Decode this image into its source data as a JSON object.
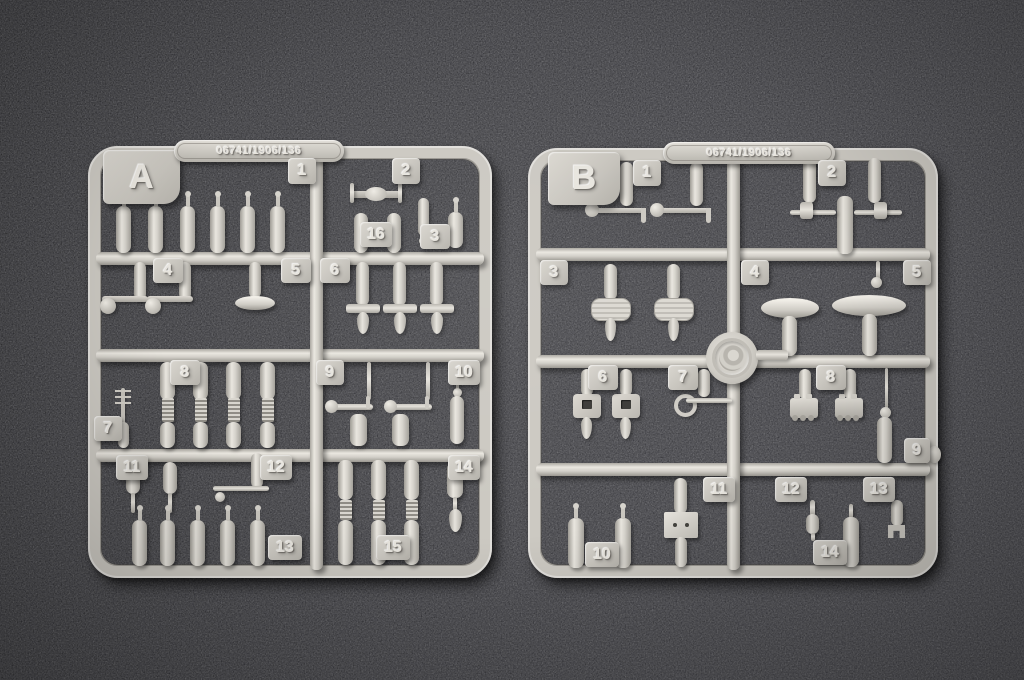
{
  "colors": {
    "mat_dark": "#2c2c2e",
    "mat_mid": "#37373a",
    "mat_light": "#434347",
    "plastic": "#cfccc5",
    "plastic_light": "#ece9e2",
    "plastic_shadow": "#a19e97",
    "emboss_text": "#e8e5de"
  },
  "sprues": {
    "a": {
      "letter": "A",
      "mold_code": "06741/1906/136",
      "tags": [
        {
          "label": "1",
          "x": 200,
          "y": 12,
          "w": 28,
          "h": 26
        },
        {
          "label": "2",
          "x": 304,
          "y": 12,
          "w": 28,
          "h": 26
        },
        {
          "label": "16",
          "x": 272,
          "y": 76,
          "w": 32,
          "h": 25
        },
        {
          "label": "3",
          "x": 332,
          "y": 78,
          "w": 30,
          "h": 25
        },
        {
          "label": "4",
          "x": 65,
          "y": 112,
          "w": 30,
          "h": 25
        },
        {
          "label": "5",
          "x": 193,
          "y": 112,
          "w": 30,
          "h": 25
        },
        {
          "label": "6",
          "x": 232,
          "y": 112,
          "w": 30,
          "h": 25
        },
        {
          "label": "7",
          "x": 6,
          "y": 270,
          "w": 28,
          "h": 25
        },
        {
          "label": "8",
          "x": 82,
          "y": 214,
          "w": 30,
          "h": 25
        },
        {
          "label": "9",
          "x": 228,
          "y": 214,
          "w": 28,
          "h": 25
        },
        {
          "label": "10",
          "x": 360,
          "y": 214,
          "w": 32,
          "h": 25
        },
        {
          "label": "11",
          "x": 28,
          "y": 309,
          "w": 32,
          "h": 25
        },
        {
          "label": "12",
          "x": 172,
          "y": 309,
          "w": 32,
          "h": 25
        },
        {
          "label": "14",
          "x": 360,
          "y": 309,
          "w": 32,
          "h": 25
        },
        {
          "label": "13",
          "x": 180,
          "y": 389,
          "w": 34,
          "h": 25
        },
        {
          "label": "15",
          "x": 288,
          "y": 389,
          "w": 34,
          "h": 25
        }
      ],
      "parts": [
        {
          "t": "bottle",
          "x": 28,
          "y": 60,
          "w": 15,
          "h": 47
        },
        {
          "t": "bottle",
          "x": 60,
          "y": 60,
          "w": 15,
          "h": 47
        },
        {
          "t": "bottle",
          "x": 92,
          "y": 60,
          "w": 15,
          "h": 47
        },
        {
          "t": "bottle",
          "x": 122,
          "y": 60,
          "w": 15,
          "h": 47
        },
        {
          "t": "bottle",
          "x": 152,
          "y": 60,
          "w": 15,
          "h": 47
        },
        {
          "t": "bottle",
          "x": 182,
          "y": 60,
          "w": 15,
          "h": 47
        },
        {
          "t": "axle",
          "x": 262,
          "y": 45,
          "w": 52,
          "h": 7
        },
        {
          "t": "bar",
          "x": 262,
          "y": 37,
          "w": 4,
          "h": 20
        },
        {
          "t": "bar",
          "x": 310,
          "y": 37,
          "w": 4,
          "h": 20
        },
        {
          "t": "capsule",
          "x": 266,
          "y": 67,
          "w": 14,
          "h": 40
        },
        {
          "t": "capsule",
          "x": 299,
          "y": 67,
          "w": 14,
          "h": 40
        },
        {
          "t": "capsule",
          "x": 330,
          "y": 52,
          "w": 11,
          "h": 38
        },
        {
          "t": "ball",
          "x": 331,
          "y": 91,
          "w": 8,
          "h": 8
        },
        {
          "t": "bottle",
          "x": 360,
          "y": 66,
          "w": 15,
          "h": 36
        },
        {
          "t": "capsule",
          "x": 46,
          "y": 116,
          "w": 12,
          "h": 38
        },
        {
          "t": "capsule",
          "x": 91,
          "y": 116,
          "w": 12,
          "h": 38
        },
        {
          "t": "davit",
          "x": 14,
          "y": 150,
          "w": 46,
          "h": 22
        },
        {
          "t": "davit",
          "x": 59,
          "y": 150,
          "w": 46,
          "h": 22
        },
        {
          "t": "capsule",
          "x": 161,
          "y": 116,
          "w": 12,
          "h": 36
        },
        {
          "t": "ellipse",
          "x": 147,
          "y": 150,
          "w": 40,
          "h": 14
        },
        {
          "t": "capsule",
          "x": 268,
          "y": 116,
          "w": 13,
          "h": 44
        },
        {
          "t": "bar",
          "x": 258,
          "y": 158,
          "w": 34,
          "h": 9
        },
        {
          "t": "tear",
          "x": 269,
          "y": 166,
          "w": 12,
          "h": 22
        },
        {
          "t": "capsule",
          "x": 305,
          "y": 116,
          "w": 13,
          "h": 44
        },
        {
          "t": "bar",
          "x": 295,
          "y": 158,
          "w": 34,
          "h": 9
        },
        {
          "t": "tear",
          "x": 306,
          "y": 166,
          "w": 12,
          "h": 22
        },
        {
          "t": "capsule",
          "x": 342,
          "y": 116,
          "w": 13,
          "h": 44
        },
        {
          "t": "bar",
          "x": 332,
          "y": 158,
          "w": 34,
          "h": 9
        },
        {
          "t": "tear",
          "x": 343,
          "y": 166,
          "w": 12,
          "h": 22
        },
        {
          "t": "mast",
          "x": 27,
          "y": 242,
          "w": 16,
          "h": 36
        },
        {
          "t": "capsule",
          "x": 30,
          "y": 276,
          "w": 11,
          "h": 26
        },
        {
          "t": "capsule",
          "x": 72,
          "y": 216,
          "w": 15,
          "h": 38
        },
        {
          "t": "ribbed",
          "x": 74,
          "y": 252,
          "w": 12,
          "h": 24
        },
        {
          "t": "capsule",
          "x": 72,
          "y": 276,
          "w": 15,
          "h": 26
        },
        {
          "t": "capsule",
          "x": 105,
          "y": 216,
          "w": 15,
          "h": 38
        },
        {
          "t": "ribbed",
          "x": 107,
          "y": 252,
          "w": 12,
          "h": 24
        },
        {
          "t": "capsule",
          "x": 105,
          "y": 276,
          "w": 15,
          "h": 26
        },
        {
          "t": "capsule",
          "x": 138,
          "y": 216,
          "w": 15,
          "h": 38
        },
        {
          "t": "ribbed",
          "x": 140,
          "y": 252,
          "w": 12,
          "h": 24
        },
        {
          "t": "capsule",
          "x": 138,
          "y": 276,
          "w": 15,
          "h": 26
        },
        {
          "t": "capsule",
          "x": 172,
          "y": 216,
          "w": 15,
          "h": 38
        },
        {
          "t": "ribbed",
          "x": 174,
          "y": 252,
          "w": 12,
          "h": 24
        },
        {
          "t": "capsule",
          "x": 172,
          "y": 276,
          "w": 15,
          "h": 26
        },
        {
          "t": "bar",
          "x": 279,
          "y": 216,
          "w": 4,
          "h": 38
        },
        {
          "t": "bar",
          "x": 338,
          "y": 216,
          "w": 4,
          "h": 38
        },
        {
          "t": "gun",
          "x": 243,
          "y": 258,
          "w": 42,
          "h": 6
        },
        {
          "t": "gun",
          "x": 302,
          "y": 258,
          "w": 42,
          "h": 6
        },
        {
          "t": "capsule",
          "x": 262,
          "y": 268,
          "w": 17,
          "h": 32
        },
        {
          "t": "capsule",
          "x": 304,
          "y": 268,
          "w": 17,
          "h": 32
        },
        {
          "t": "bar",
          "x": 368,
          "y": 216,
          "w": 3,
          "h": 28
        },
        {
          "t": "ball",
          "x": 365,
          "y": 242,
          "w": 9,
          "h": 9
        },
        {
          "t": "capsule",
          "x": 362,
          "y": 250,
          "w": 14,
          "h": 48
        },
        {
          "t": "capsule",
          "x": 38,
          "y": 316,
          "w": 14,
          "h": 32
        },
        {
          "t": "bar",
          "x": 43,
          "y": 347,
          "w": 4,
          "h": 20
        },
        {
          "t": "capsule",
          "x": 75,
          "y": 316,
          "w": 14,
          "h": 32
        },
        {
          "t": "bar",
          "x": 80,
          "y": 347,
          "w": 4,
          "h": 20
        },
        {
          "t": "capsule",
          "x": 163,
          "y": 307,
          "w": 12,
          "h": 35
        },
        {
          "t": "bar",
          "x": 125,
          "y": 340,
          "w": 56,
          "h": 5
        },
        {
          "t": "ball",
          "x": 127,
          "y": 346,
          "w": 10,
          "h": 10
        },
        {
          "t": "bottle",
          "x": 44,
          "y": 374,
          "w": 15,
          "h": 46
        },
        {
          "t": "bottle",
          "x": 72,
          "y": 374,
          "w": 15,
          "h": 46
        },
        {
          "t": "bottle",
          "x": 102,
          "y": 374,
          "w": 15,
          "h": 46
        },
        {
          "t": "bottle",
          "x": 132,
          "y": 374,
          "w": 15,
          "h": 46
        },
        {
          "t": "bottle",
          "x": 162,
          "y": 374,
          "w": 15,
          "h": 46
        },
        {
          "t": "capsule",
          "x": 359,
          "y": 316,
          "w": 16,
          "h": 36
        },
        {
          "t": "bar",
          "x": 365,
          "y": 351,
          "w": 4,
          "h": 14
        },
        {
          "t": "tear",
          "x": 361,
          "y": 363,
          "w": 13,
          "h": 23
        },
        {
          "t": "capsule",
          "x": 250,
          "y": 314,
          "w": 15,
          "h": 40
        },
        {
          "t": "ribbed",
          "x": 252,
          "y": 354,
          "w": 12,
          "h": 20
        },
        {
          "t": "capsule",
          "x": 250,
          "y": 374,
          "w": 15,
          "h": 45
        },
        {
          "t": "capsule",
          "x": 283,
          "y": 314,
          "w": 15,
          "h": 40
        },
        {
          "t": "ribbed",
          "x": 285,
          "y": 354,
          "w": 12,
          "h": 20
        },
        {
          "t": "capsule",
          "x": 283,
          "y": 374,
          "w": 15,
          "h": 45
        },
        {
          "t": "capsule",
          "x": 316,
          "y": 314,
          "w": 15,
          "h": 40
        },
        {
          "t": "ribbed",
          "x": 318,
          "y": 354,
          "w": 12,
          "h": 20
        },
        {
          "t": "capsule",
          "x": 316,
          "y": 374,
          "w": 15,
          "h": 45
        }
      ]
    },
    "b": {
      "letter": "B",
      "mold_code": "06741/1906/136",
      "tags": [
        {
          "label": "1",
          "x": 105,
          "y": 12,
          "w": 28,
          "h": 26
        },
        {
          "label": "2",
          "x": 290,
          "y": 12,
          "w": 28,
          "h": 26
        },
        {
          "label": "3",
          "x": 12,
          "y": 112,
          "w": 28,
          "h": 25
        },
        {
          "label": "4",
          "x": 213,
          "y": 112,
          "w": 28,
          "h": 25
        },
        {
          "label": "5",
          "x": 375,
          "y": 112,
          "w": 28,
          "h": 25
        },
        {
          "label": "6",
          "x": 60,
          "y": 217,
          "w": 30,
          "h": 25
        },
        {
          "label": "7",
          "x": 140,
          "y": 217,
          "w": 30,
          "h": 25
        },
        {
          "label": "8",
          "x": 288,
          "y": 217,
          "w": 30,
          "h": 25
        },
        {
          "label": "9",
          "x": 376,
          "y": 290,
          "w": 26,
          "h": 25
        },
        {
          "label": "11",
          "x": 175,
          "y": 329,
          "w": 32,
          "h": 25
        },
        {
          "label": "12",
          "x": 247,
          "y": 329,
          "w": 32,
          "h": 25
        },
        {
          "label": "13",
          "x": 335,
          "y": 329,
          "w": 32,
          "h": 25
        },
        {
          "label": "10",
          "x": 57,
          "y": 394,
          "w": 34,
          "h": 25
        },
        {
          "label": "14",
          "x": 285,
          "y": 392,
          "w": 34,
          "h": 25
        }
      ],
      "parts": [
        {
          "t": "capsule",
          "x": 92,
          "y": 14,
          "w": 13,
          "h": 44
        },
        {
          "t": "capsule",
          "x": 162,
          "y": 14,
          "w": 13,
          "h": 44
        },
        {
          "t": "pipe",
          "x": 64,
          "y": 60,
          "w": 52,
          "h": 5
        },
        {
          "t": "pipe",
          "x": 129,
          "y": 60,
          "w": 52,
          "h": 5
        },
        {
          "t": "capsule",
          "x": 275,
          "y": 10,
          "w": 13,
          "h": 45
        },
        {
          "t": "capsule",
          "x": 340,
          "y": 10,
          "w": 13,
          "h": 45
        },
        {
          "t": "capsule",
          "x": 309,
          "y": 48,
          "w": 16,
          "h": 58
        },
        {
          "t": "bar",
          "x": 262,
          "y": 62,
          "w": 46,
          "h": 5
        },
        {
          "t": "bar",
          "x": 326,
          "y": 62,
          "w": 48,
          "h": 5
        },
        {
          "t": "bar",
          "x": 272,
          "y": 54,
          "w": 13,
          "h": 17
        },
        {
          "t": "bar",
          "x": 346,
          "y": 54,
          "w": 13,
          "h": 17
        },
        {
          "t": "capsule",
          "x": 76,
          "y": 116,
          "w": 13,
          "h": 36
        },
        {
          "t": "ovalplate",
          "x": 63,
          "y": 150,
          "w": 38,
          "h": 21
        },
        {
          "t": "tear",
          "x": 77,
          "y": 170,
          "w": 11,
          "h": 23
        },
        {
          "t": "capsule",
          "x": 139,
          "y": 116,
          "w": 13,
          "h": 36
        },
        {
          "t": "ovalplate",
          "x": 126,
          "y": 150,
          "w": 38,
          "h": 21
        },
        {
          "t": "tear",
          "x": 140,
          "y": 170,
          "w": 11,
          "h": 23
        },
        {
          "t": "ellipse",
          "x": 233,
          "y": 150,
          "w": 58,
          "h": 20
        },
        {
          "t": "capsule",
          "x": 254,
          "y": 168,
          "w": 15,
          "h": 40
        },
        {
          "t": "ellipse",
          "x": 304,
          "y": 147,
          "w": 74,
          "h": 21
        },
        {
          "t": "capsule",
          "x": 334,
          "y": 166,
          "w": 15,
          "h": 42
        },
        {
          "t": "bar",
          "x": 348,
          "y": 113,
          "w": 4,
          "h": 19
        },
        {
          "t": "ball",
          "x": 343,
          "y": 129,
          "w": 11,
          "h": 11
        },
        {
          "t": "emblem",
          "x": 178,
          "y": 184,
          "w": 52,
          "h": 52
        },
        {
          "t": "bar",
          "x": 228,
          "y": 202,
          "w": 32,
          "h": 10
        },
        {
          "t": "capsule",
          "x": 53,
          "y": 221,
          "w": 12,
          "h": 27
        },
        {
          "t": "clamp",
          "x": 45,
          "y": 246,
          "w": 28,
          "h": 24
        },
        {
          "t": "tear",
          "x": 53,
          "y": 269,
          "w": 11,
          "h": 22
        },
        {
          "t": "capsule",
          "x": 92,
          "y": 221,
          "w": 12,
          "h": 27
        },
        {
          "t": "clamp",
          "x": 84,
          "y": 246,
          "w": 28,
          "h": 24
        },
        {
          "t": "tear",
          "x": 92,
          "y": 269,
          "w": 11,
          "h": 22
        },
        {
          "t": "capsule",
          "x": 170,
          "y": 221,
          "w": 12,
          "h": 28
        },
        {
          "t": "ring",
          "x": 146,
          "y": 246,
          "w": 15,
          "h": 15
        },
        {
          "t": "bar",
          "x": 158,
          "y": 250,
          "w": 46,
          "h": 5
        },
        {
          "t": "capsule",
          "x": 271,
          "y": 221,
          "w": 12,
          "h": 30
        },
        {
          "t": "carriage",
          "x": 262,
          "y": 250,
          "w": 28,
          "h": 20
        },
        {
          "t": "capsule",
          "x": 316,
          "y": 221,
          "w": 12,
          "h": 30
        },
        {
          "t": "carriage",
          "x": 307,
          "y": 250,
          "w": 28,
          "h": 20
        },
        {
          "t": "bar",
          "x": 357,
          "y": 220,
          "w": 3,
          "h": 42
        },
        {
          "t": "ball",
          "x": 352,
          "y": 259,
          "w": 11,
          "h": 11
        },
        {
          "t": "capsule",
          "x": 349,
          "y": 269,
          "w": 15,
          "h": 46
        },
        {
          "t": "bottle",
          "x": 40,
          "y": 370,
          "w": 16,
          "h": 50
        },
        {
          "t": "bottle",
          "x": 87,
          "y": 370,
          "w": 16,
          "h": 50
        },
        {
          "t": "capsule",
          "x": 146,
          "y": 330,
          "w": 13,
          "h": 36
        },
        {
          "t": "plate2",
          "x": 136,
          "y": 364,
          "w": 34,
          "h": 26
        },
        {
          "t": "capsule",
          "x": 147,
          "y": 389,
          "w": 12,
          "h": 30
        },
        {
          "t": "bar",
          "x": 282,
          "y": 352,
          "w": 5,
          "h": 16
        },
        {
          "t": "capsule",
          "x": 278,
          "y": 366,
          "w": 13,
          "h": 20
        },
        {
          "t": "bar",
          "x": 283,
          "y": 385,
          "w": 4,
          "h": 8
        },
        {
          "t": "capsule",
          "x": 363,
          "y": 352,
          "w": 12,
          "h": 26
        },
        {
          "t": "mfeet",
          "x": 360,
          "y": 377,
          "w": 17,
          "h": 13
        },
        {
          "t": "bar",
          "x": 321,
          "y": 356,
          "w": 4,
          "h": 14
        },
        {
          "t": "capsule",
          "x": 315,
          "y": 369,
          "w": 16,
          "h": 50
        },
        {
          "t": "ball",
          "x": 400,
          "y": 298,
          "w": 13,
          "h": 17
        }
      ]
    }
  }
}
